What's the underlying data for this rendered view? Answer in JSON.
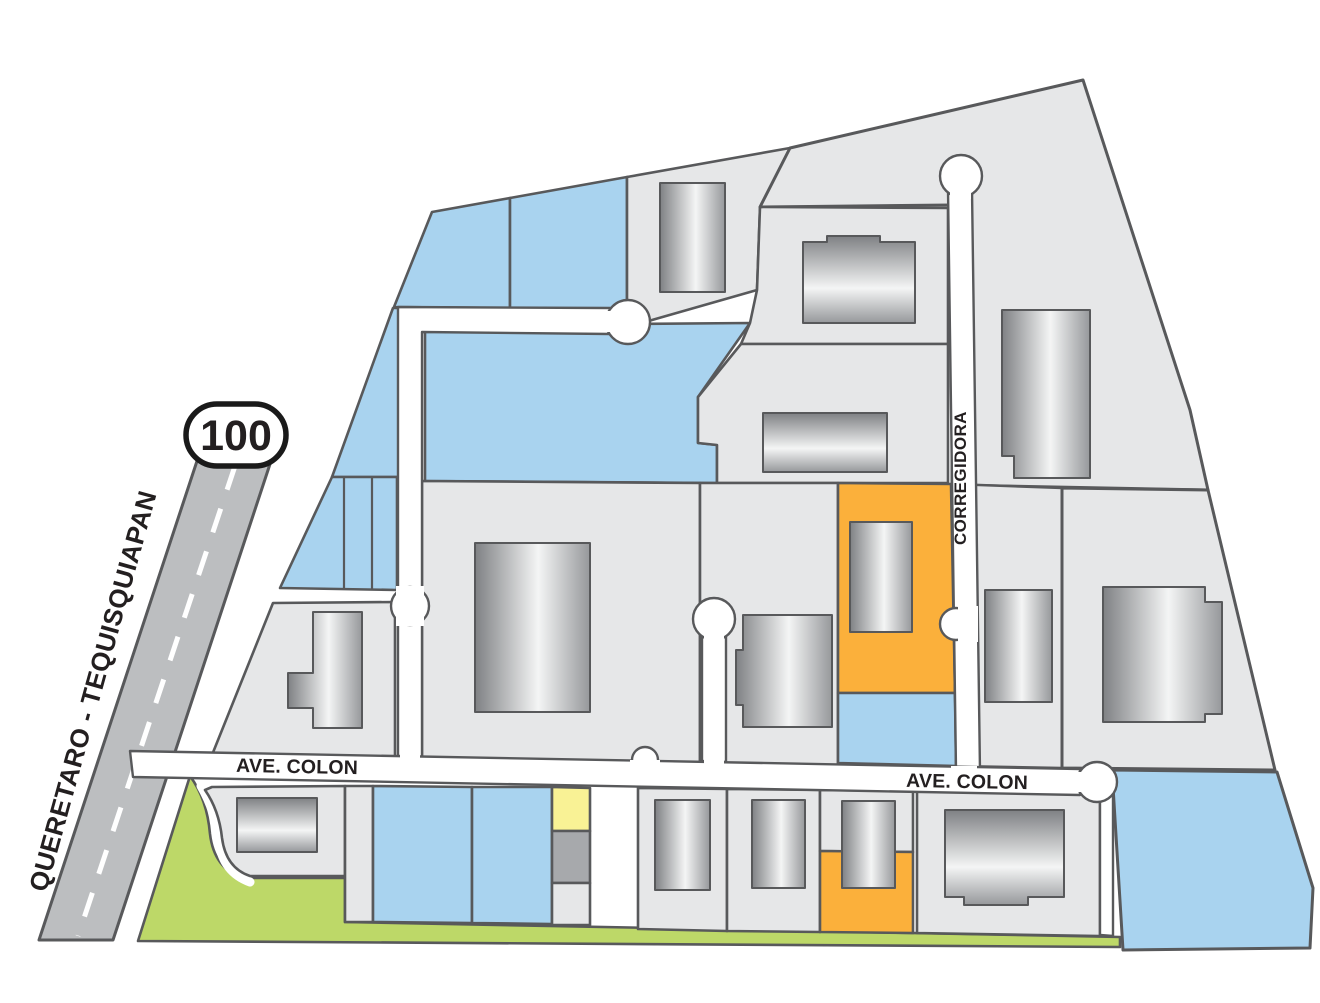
{
  "labels": {
    "highway": "QUERETARO - TEQUISQUIAPAN",
    "route_number": "100",
    "ave_colon_west": "AVE. COLON",
    "ave_colon_east": "AVE. COLON",
    "corregidora": "CORREGIDORA"
  },
  "colors": {
    "parcel_gray": "#E6E7E8",
    "parcel_blue": "#A9D3EF",
    "parcel_orange": "#FBB03B",
    "parcel_yellow": "#F9F295",
    "parcel_green": "#BDD868",
    "parcel_midgray": "#A7A9AC",
    "road_white": "#FFFFFF",
    "highway_gray": "#BCBEC0",
    "line_dark": "#58595B",
    "label_black": "#231F20",
    "shield_white": "#FFFFFF",
    "building_dark": "#7F8184",
    "building_light": "#F4F5F5",
    "building_mid": "#96989B"
  }
}
